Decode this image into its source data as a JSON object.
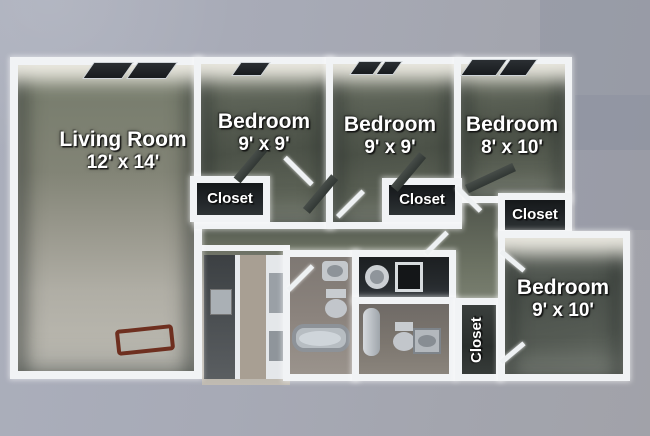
{
  "rooms": {
    "living_room": {
      "name": "Living Room",
      "dims": "12' x 14'"
    },
    "bedroom_1": {
      "name": "Bedroom",
      "dims": "9' x 9'"
    },
    "bedroom_2": {
      "name": "Bedroom",
      "dims": "9' x 9'"
    },
    "bedroom_3": {
      "name": "Bedroom",
      "dims": "8' x 10'"
    },
    "bedroom_4": {
      "name": "Bedroom",
      "dims": "9' x 10'"
    },
    "closet_1": {
      "label": "Closet"
    },
    "closet_2": {
      "label": "Closet"
    },
    "closet_3": {
      "label": "Closet"
    },
    "closet_4": {
      "label": "Closet"
    }
  },
  "colors": {
    "background": "#a6a9b4",
    "wall": "#f1f3f5",
    "bedroom_floor": "#555b50",
    "living_floor_upper": "#7d8272",
    "living_floor_lower": "#b7b5ad",
    "closet_floor": "#22262a",
    "label_text": "#ffffff",
    "accent_wood": "#6e2f1f"
  }
}
